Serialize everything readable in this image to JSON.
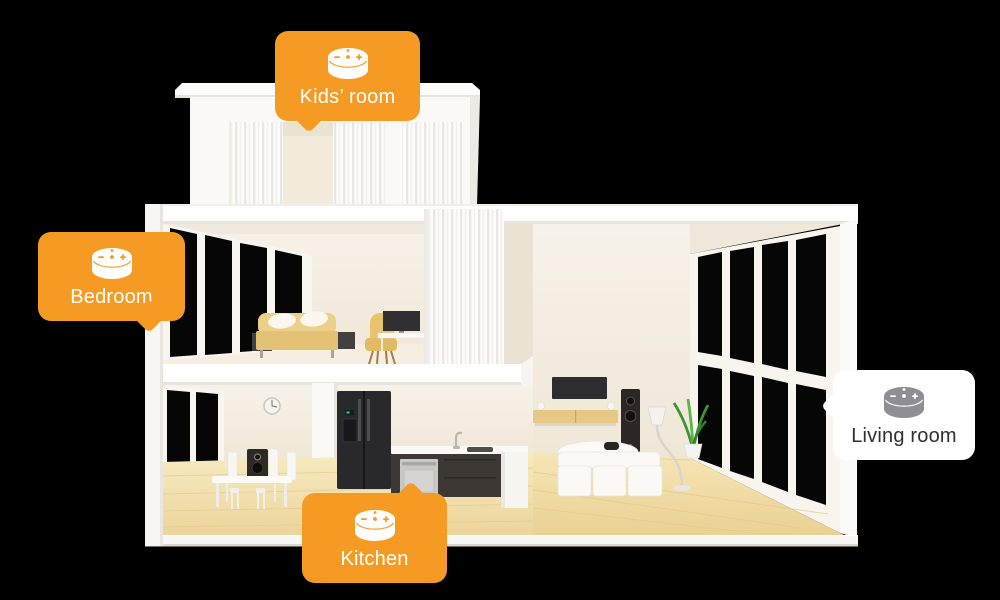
{
  "scene": {
    "background_color": "#000000",
    "description": "3D cutaway model house with smart-speaker room callouts"
  },
  "colors": {
    "accent_orange": "#F59B23",
    "bubble_white": "#FFFFFF",
    "label_on_orange": "#FFFFFF",
    "label_on_white": "#2F2F31",
    "icon_gray": "#8E8E93",
    "background": "#000000"
  },
  "callouts": [
    {
      "id": "kids-room",
      "label": "Kids’ room",
      "bubble_color": "#F59B23",
      "text_color": "#FFFFFF",
      "icon": "echo-dot-speaker",
      "icon_color": "#FFFFFF",
      "icon_mark_color": "#F59B23",
      "tail": "bottom-left"
    },
    {
      "id": "bedroom",
      "label": "Bedroom",
      "bubble_color": "#F59B23",
      "text_color": "#FFFFFF",
      "icon": "echo-dot-speaker",
      "icon_color": "#FFFFFF",
      "icon_mark_color": "#F59B23",
      "tail": "bottom-right"
    },
    {
      "id": "kitchen",
      "label": "Kitchen",
      "bubble_color": "#F59B23",
      "text_color": "#FFFFFF",
      "icon": "echo-dot-speaker",
      "icon_color": "#FFFFFF",
      "icon_mark_color": "#F59B23",
      "tail": "top-right"
    },
    {
      "id": "living-room",
      "label": "Living room",
      "bubble_color": "#FFFFFF",
      "text_color": "#2F2F31",
      "icon": "echo-dot-speaker",
      "icon_color": "#8E8E93",
      "icon_mark_color": "#FFFFFF",
      "tail": "left"
    }
  ]
}
